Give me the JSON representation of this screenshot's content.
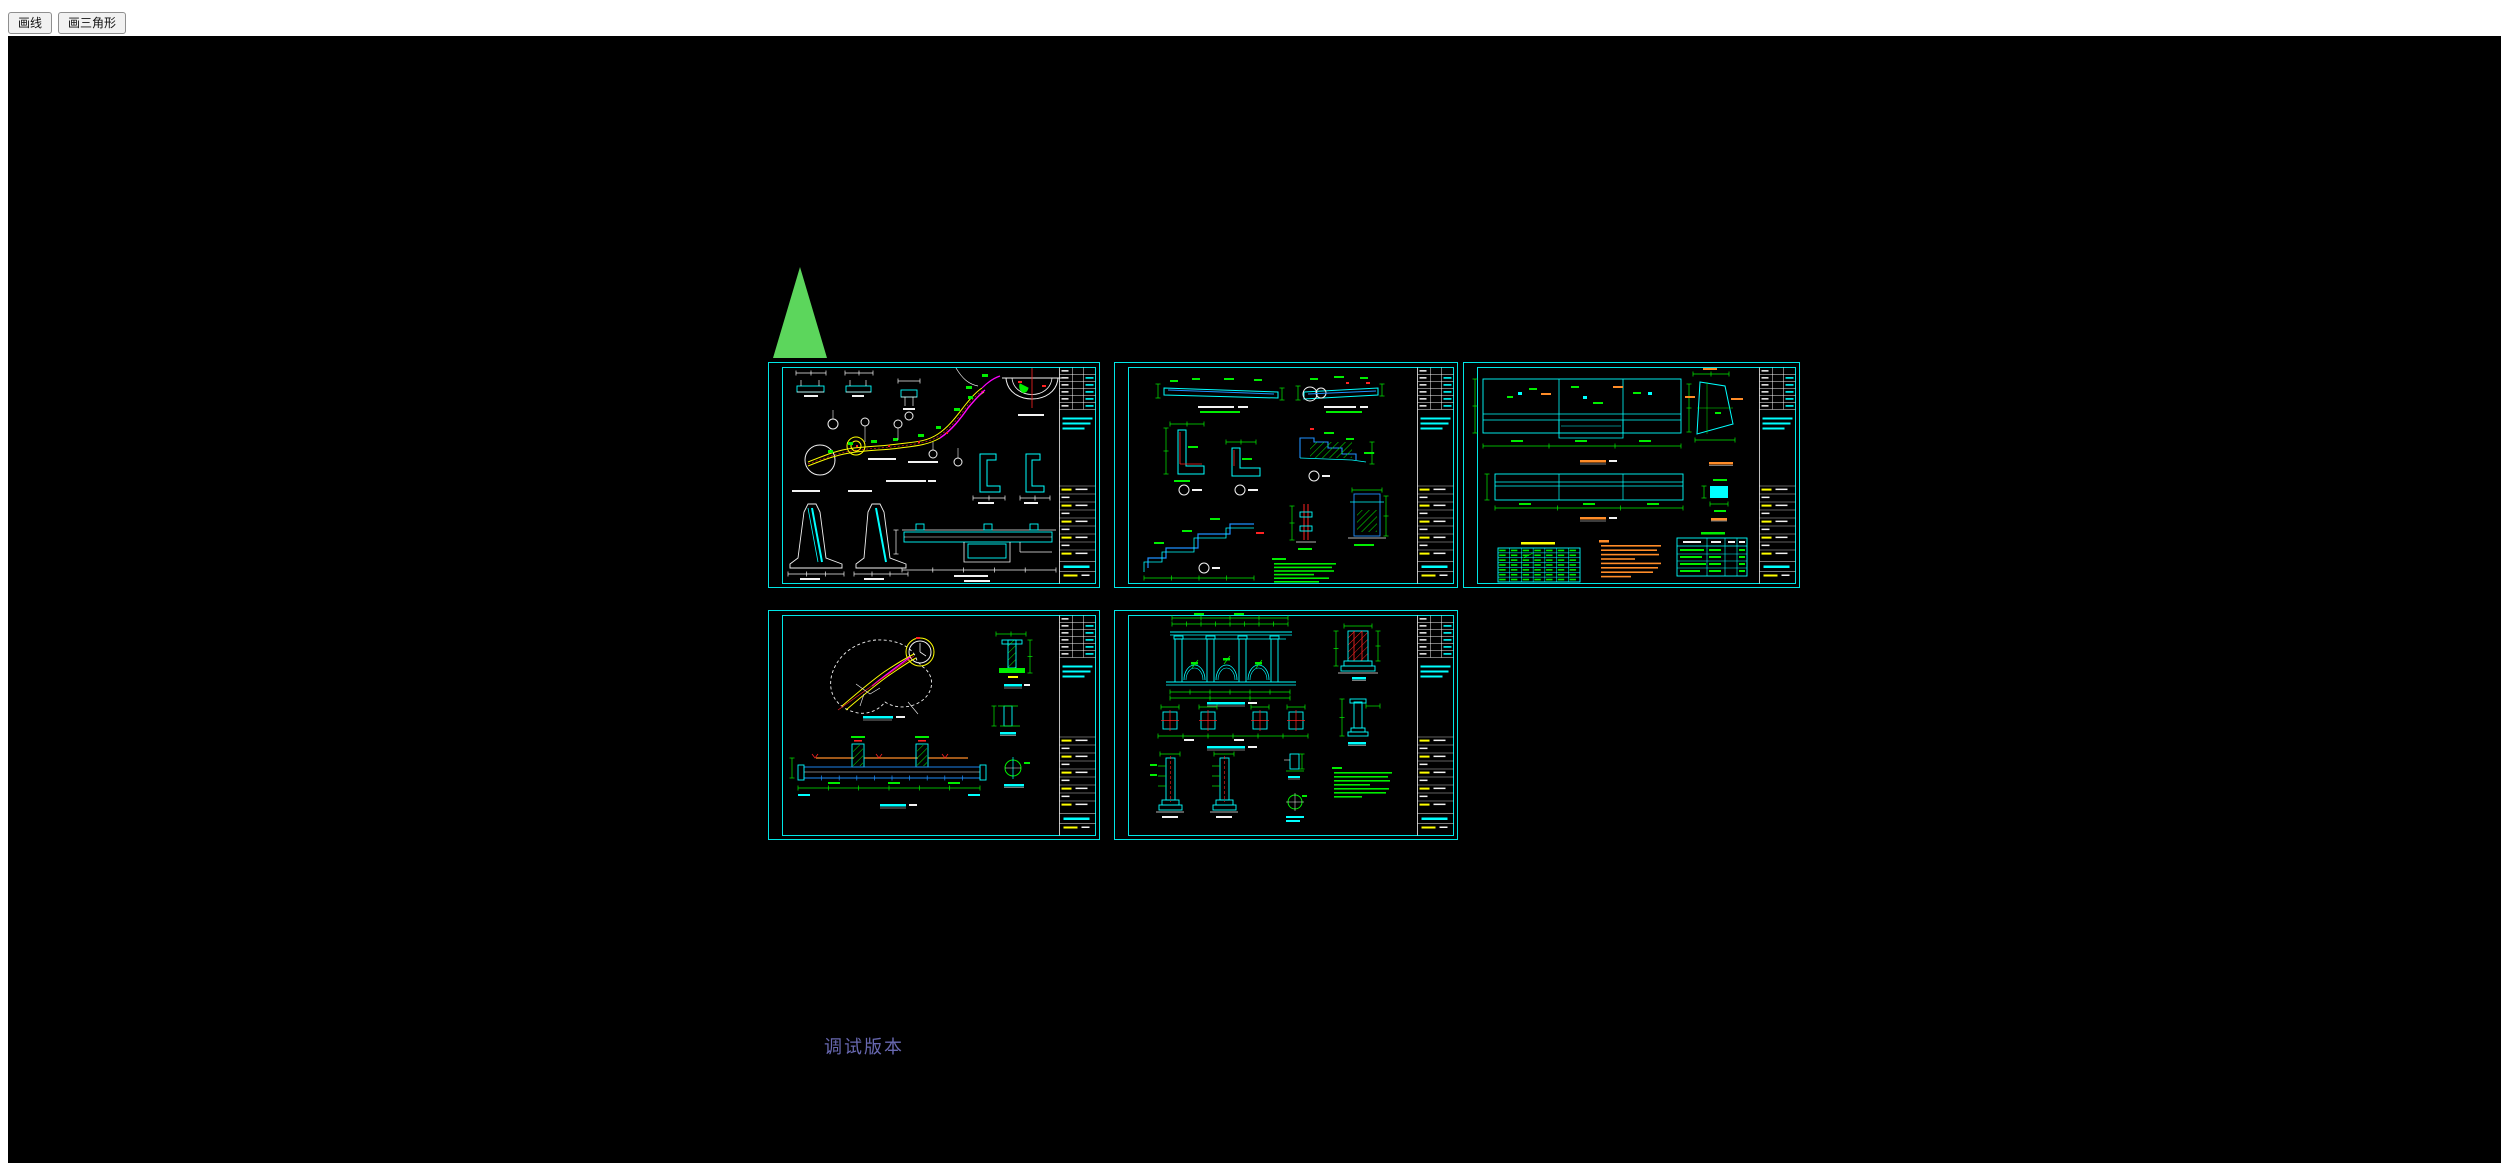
{
  "toolbar": {
    "buttons": [
      {
        "id": "draw-line",
        "label": "画线"
      },
      {
        "id": "draw-triangle",
        "label": "画三角形"
      }
    ]
  },
  "canvas": {
    "debug_label": "调试版本",
    "background": "#000000"
  },
  "palette": {
    "border_cyan": "#00ffff",
    "line_white": "#f2f2f2",
    "cad_green": "#00ee00",
    "cad_yellow": "#ffff00",
    "cad_magenta": "#ff00ff",
    "cad_red": "#ff2222",
    "cad_blue": "#1e90ff",
    "cad_orange": "#ff8c28",
    "triangle_green": "#5cd65c",
    "debug_text": "#6868b0",
    "toolbar_bg": "#ffffff"
  },
  "triangle": {
    "apex_x": 800,
    "apex_y": 267,
    "base_left": 773,
    "base_right": 827,
    "base_y": 358
  },
  "sheets": [
    {
      "id": "cad-sheet-1",
      "x": 768,
      "y": 362,
      "w": 332,
      "h": 226
    },
    {
      "id": "cad-sheet-2",
      "x": 1114,
      "y": 362,
      "w": 344,
      "h": 226
    },
    {
      "id": "cad-sheet-3",
      "x": 1463,
      "y": 362,
      "w": 337,
      "h": 226
    },
    {
      "id": "cad-sheet-4",
      "x": 768,
      "y": 610,
      "w": 332,
      "h": 230
    },
    {
      "id": "cad-sheet-5",
      "x": 1114,
      "y": 610,
      "w": 344,
      "h": 230
    }
  ]
}
